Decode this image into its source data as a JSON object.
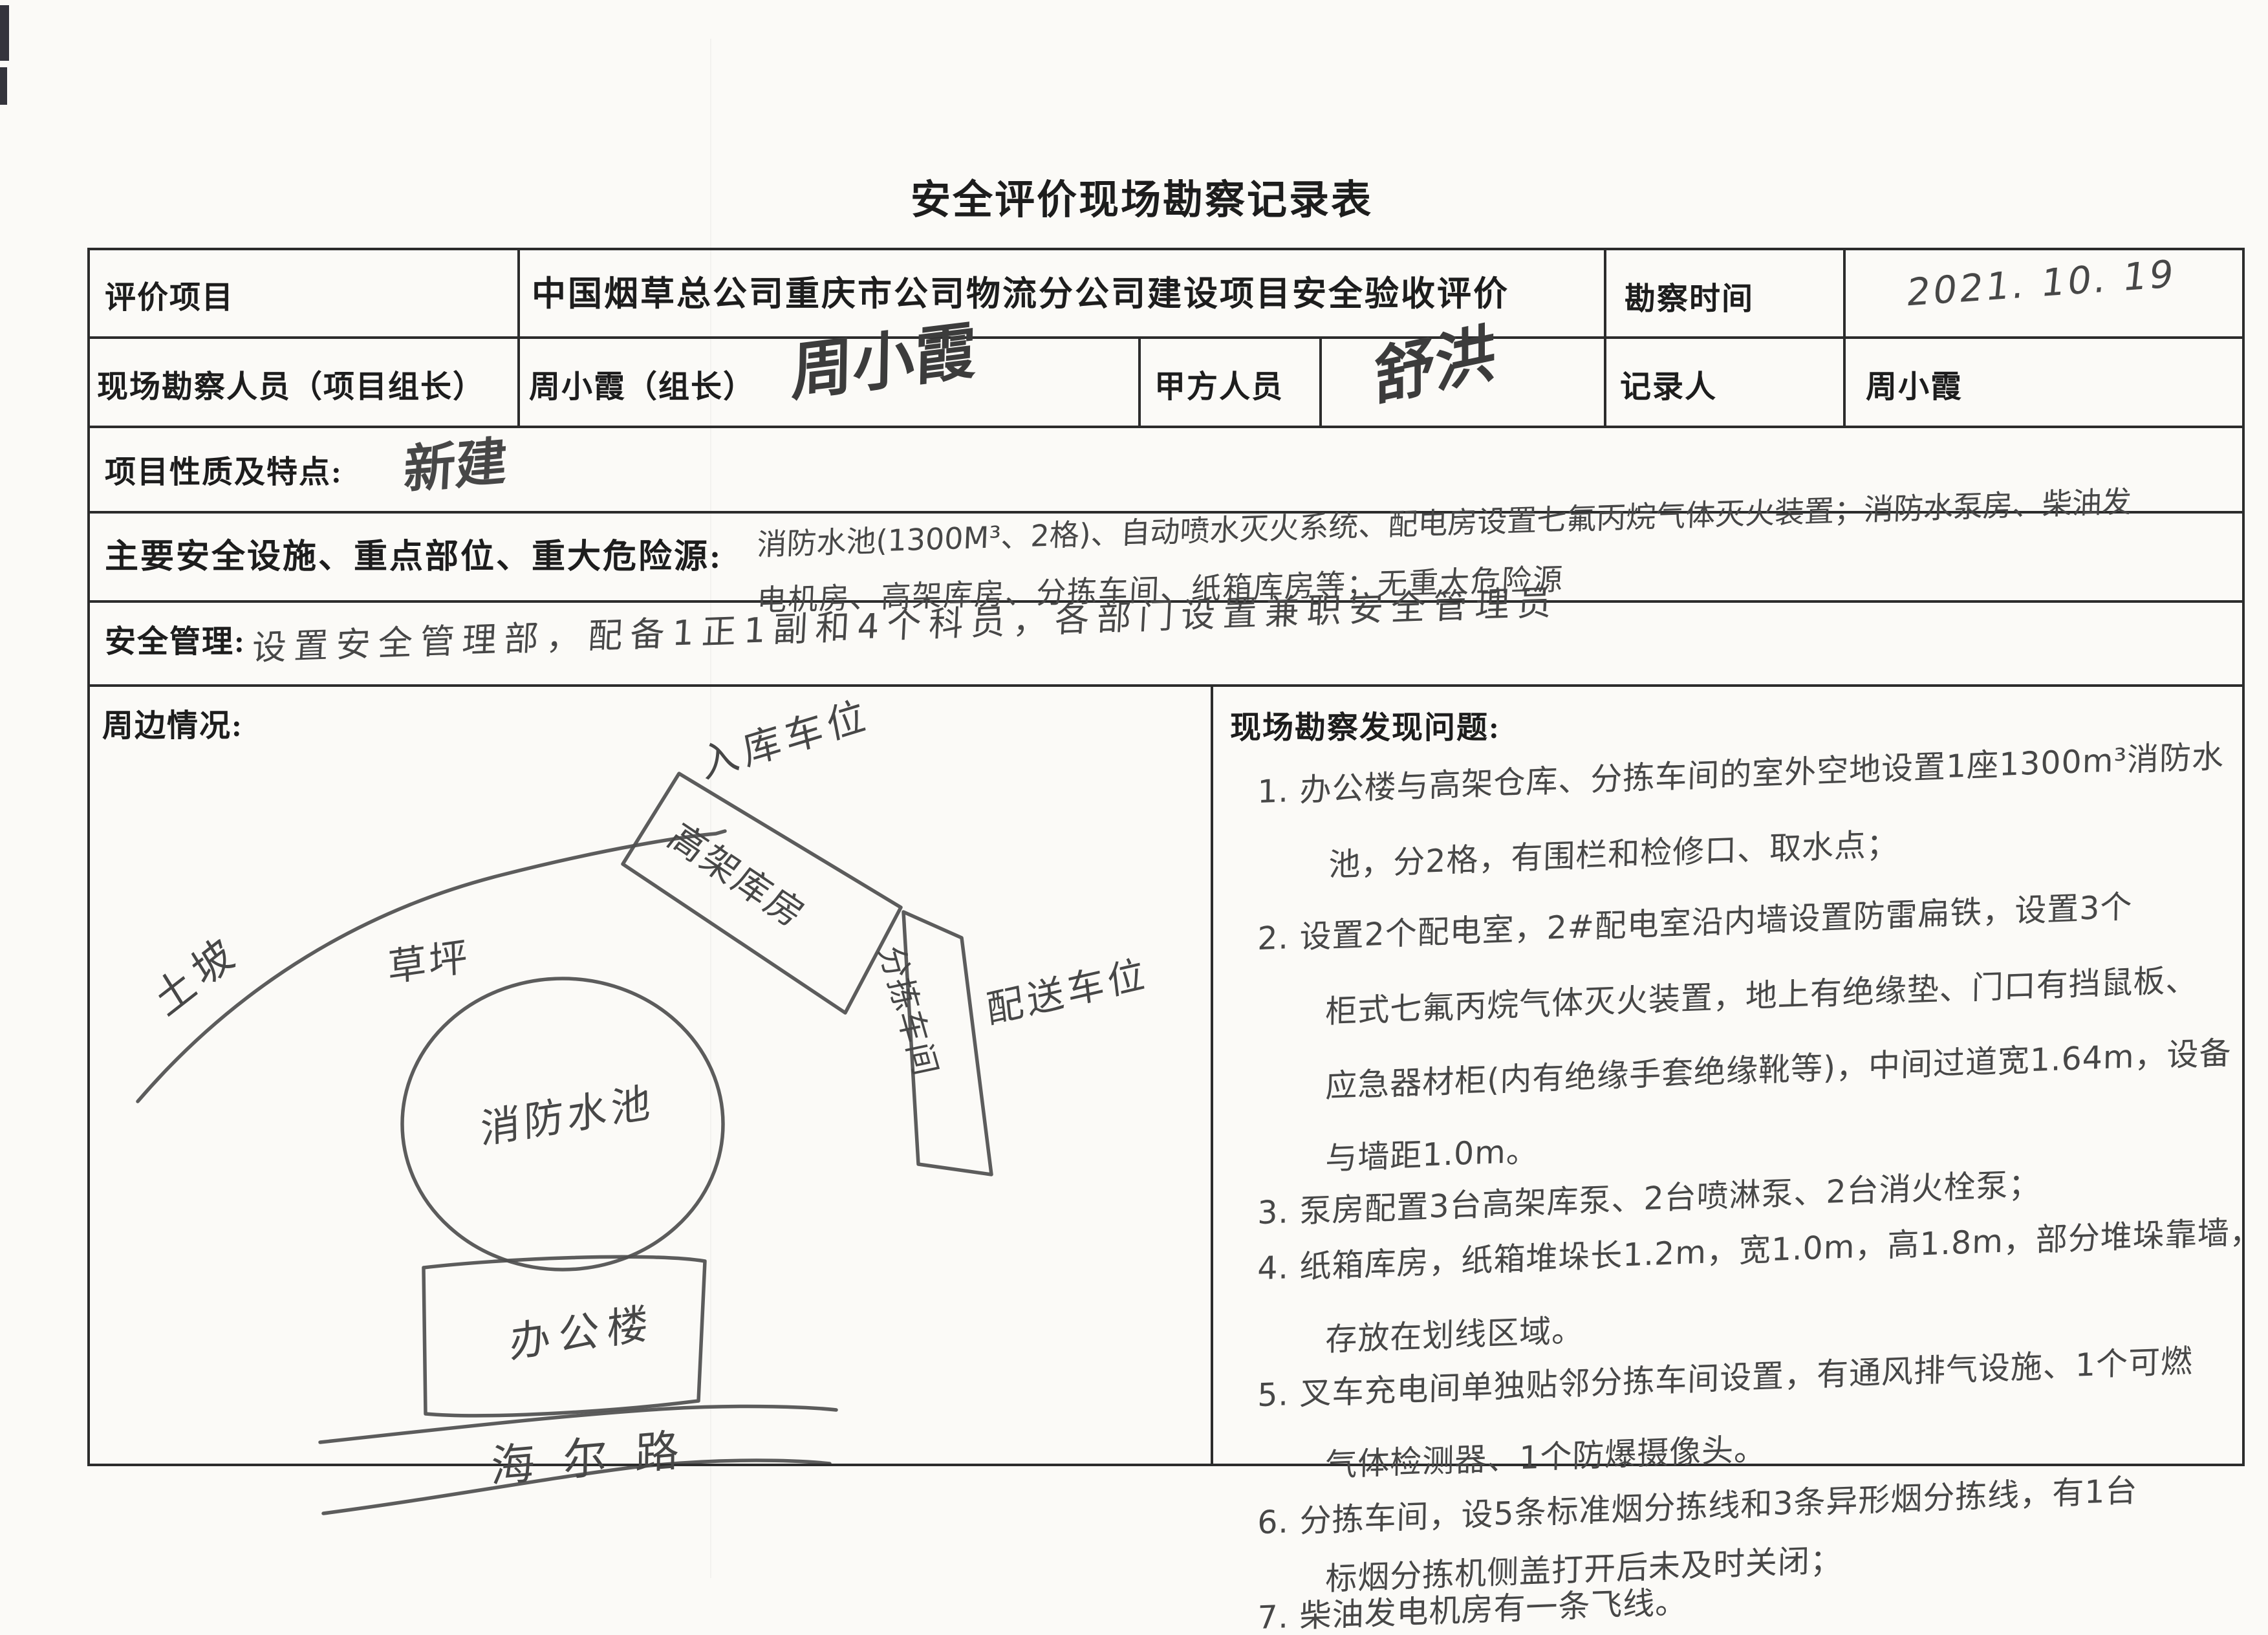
{
  "doc": {
    "title": "安全评价现场勘察记录表"
  },
  "header": {
    "project_label": "评价项目",
    "project_value": "中国烟草总公司重庆市公司物流分公司建设项目安全验收评价",
    "survey_time_label": "勘察时间",
    "survey_time_value": "2021. 10. 19",
    "surveyor_label": "现场勘察人员（项目组长）",
    "surveyor_printed": "周小霞（组长）",
    "surveyor_signature": "周小霞",
    "party_a_label": "甲方人员",
    "party_a_signature": "舒洪",
    "recorder_label": "记录人",
    "recorder_value": "周小霞"
  },
  "sections": {
    "nature_label": "项目性质及特点:",
    "nature_value": "新建",
    "facilities_label": "主要安全设施、重点部位、重大危险源:",
    "facilities_line1": "消防水池(1300M³、2格)、自动喷水灭火系统、配电房设置七氟丙烷气体灭火装置；消防水泵房、柴油发",
    "facilities_line2": "电机房、高架库房、分拣车间、纸箱库房等；无重大危险源",
    "management_label": "安全管理:",
    "management_value": "设置安全管理部，配备1正1副和4个科员，各部门设置兼职安全管理员"
  },
  "surroundings": {
    "label": "周边情况:",
    "sketch": {
      "slope": "土坡",
      "lawn": "草坪",
      "inbound_parking": "入库车位",
      "rack_warehouse": "高架库房",
      "sorting_workshop": "分拣车间",
      "delivery_parking": "配送车位",
      "fire_pool": "消防水池",
      "office_building": "办公楼",
      "road": "海尔路"
    }
  },
  "findings": {
    "label": "现场勘察发现问题:",
    "lines": [
      "1. 办公楼与高架仓库、分拣车间的室外空地设置1座1300m³消防水",
      "池，分2格，有围栏和检修口、取水点；",
      "2. 设置2个配电室，2#配电室沿内墙设置防雷扁铁，设置3个",
      "柜式七氟丙烷气体灭火装置，地上有绝缘垫、门口有挡鼠板、",
      "应急器材柜(内有绝缘手套绝缘靴等)，中间过道宽1.64m，设备",
      "与墙距1.0m。",
      "3. 泵房配置3台高架库泵、2台喷淋泵、2台消火栓泵；",
      "4. 纸箱库房，纸箱堆垛长1.2m，宽1.0m，高1.8m，部分堆垛靠墙，",
      "存放在划线区域。",
      "5. 叉车充电间单独贴邻分拣车间设置，有通风排气设施、1个可燃",
      "气体检测器、1个防爆摄像头。",
      "6. 分拣车间，设5条标准烟分拣线和3条异形烟分拣线，有1台",
      "标烟分拣机侧盖打开后未及时关闭；",
      "7. 柴油发电机房有一条飞线。"
    ]
  }
}
